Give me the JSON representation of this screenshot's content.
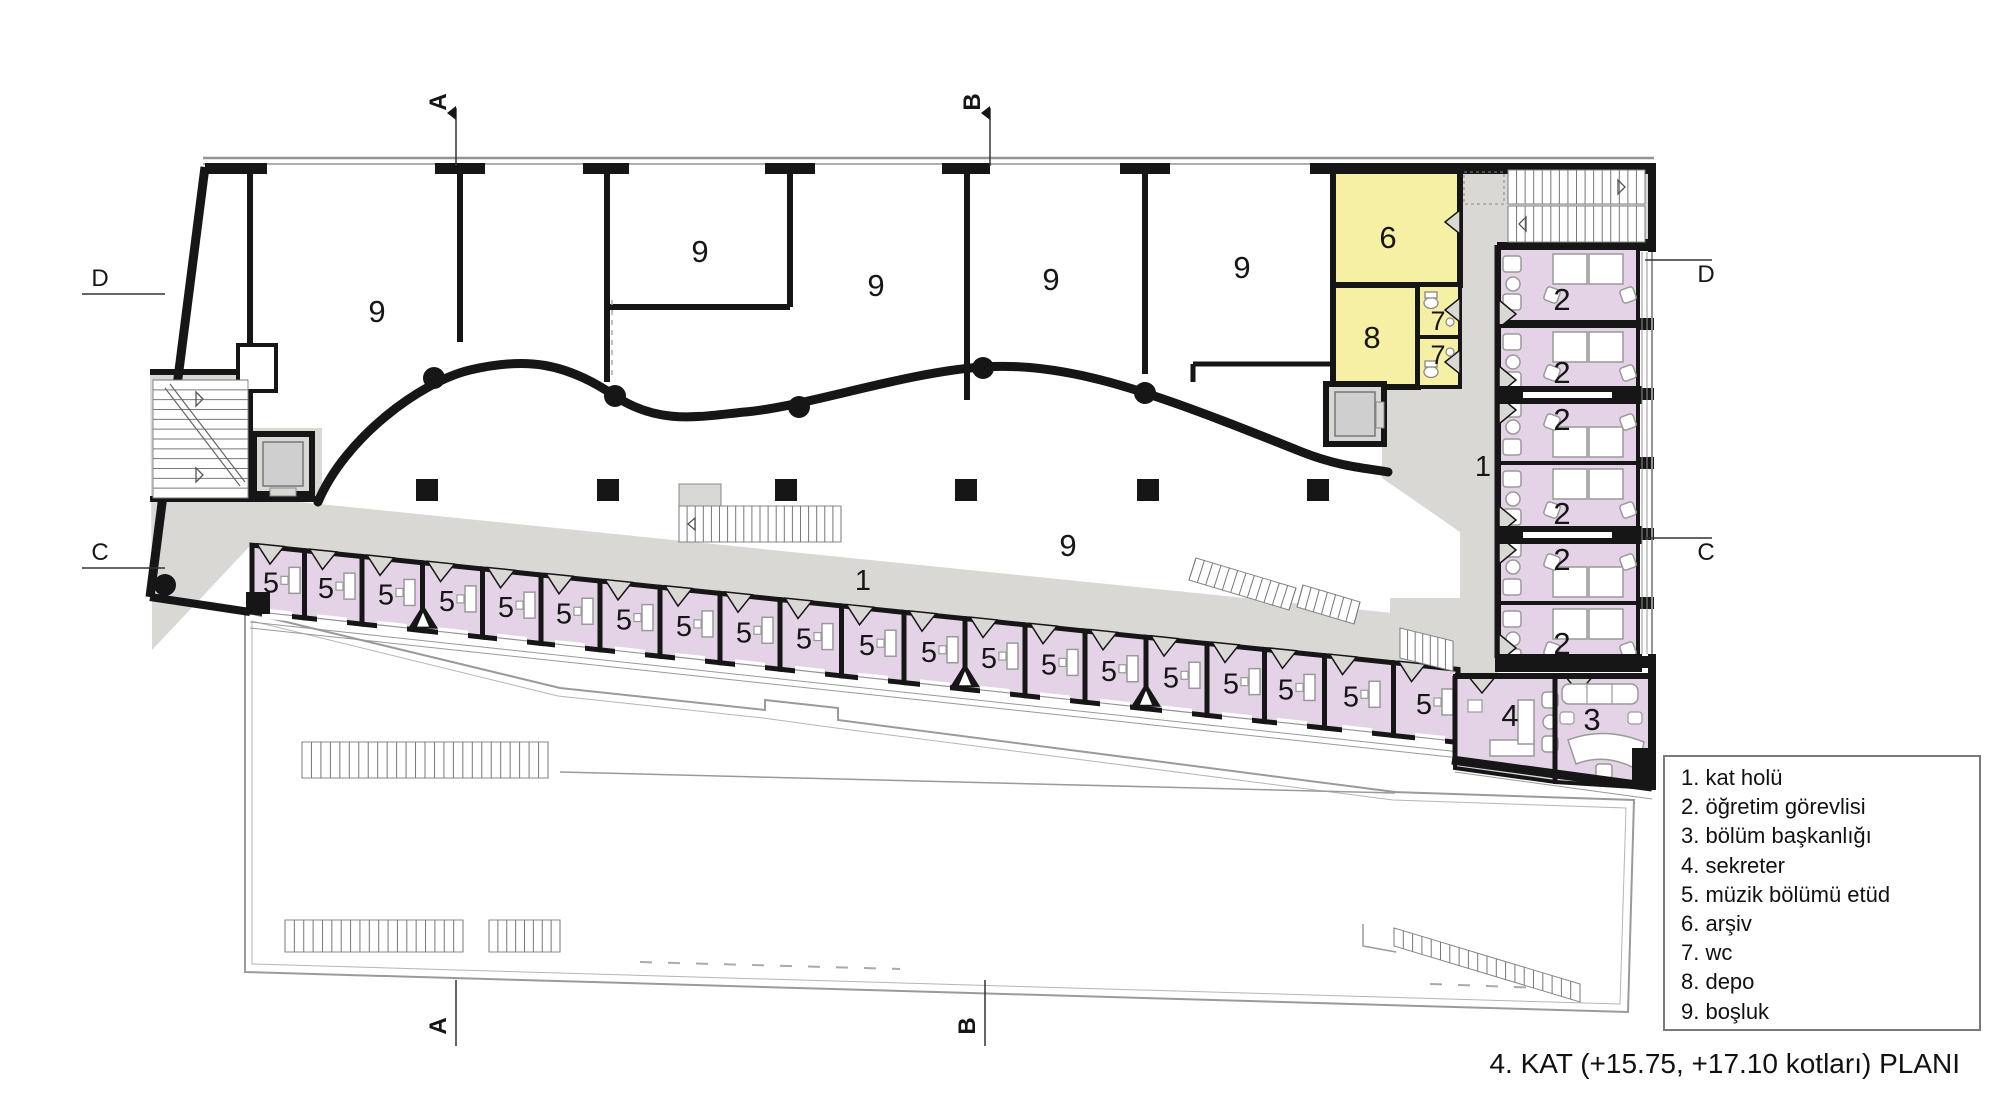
{
  "title": "4. KAT  (+15.75, +17.10 kotları) PLANI",
  "legend": [
    "1. kat holü",
    "2. öğretim görevlisi",
    "3. bölüm başkanlığı",
    "4. sekreter",
    "5. müzik bölümü etüd",
    "6. arşiv",
    "7. wc",
    "8. depo",
    "9. boşluk"
  ],
  "numbers": {
    "hall": "1",
    "office": "2",
    "head": "3",
    "secretary": "4",
    "etud": "5",
    "archive": "6",
    "wc": "7",
    "depot": "8",
    "void": "9"
  },
  "markers": {
    "top": [
      {
        "label": "A",
        "x": 456
      },
      {
        "label": "B",
        "x": 990
      }
    ],
    "bottom": [
      {
        "label": "A",
        "x": 456
      },
      {
        "label": "B",
        "x": 985
      }
    ],
    "left": [
      {
        "label": "D",
        "y": 278
      },
      {
        "label": "C",
        "y": 552
      }
    ],
    "right": [
      {
        "label": "D",
        "y": 274
      },
      {
        "label": "C",
        "y": 552
      }
    ]
  },
  "labels": {
    "nine": [
      [
        377,
        322
      ],
      [
        700,
        262
      ],
      [
        876,
        296
      ],
      [
        1051,
        290
      ],
      [
        1242,
        278
      ],
      [
        1068,
        556
      ]
    ],
    "one": [
      [
        863,
        590
      ],
      [
        1483,
        476
      ]
    ],
    "five_x": [
      277,
      332,
      392,
      453,
      512,
      570,
      630,
      690,
      750,
      810,
      873,
      935,
      995,
      1055,
      1115,
      1177,
      1237,
      1292,
      1357,
      1430
    ],
    "two_y": [
      300,
      373,
      420,
      514,
      560,
      644
    ],
    "four": [
      1510,
      726
    ],
    "three": [
      1592,
      730
    ],
    "six": [
      1388,
      248
    ],
    "eight": [
      1372,
      348
    ],
    "seven": [
      [
        1438,
        330
      ],
      [
        1438,
        364
      ]
    ]
  },
  "colors": {
    "wall": "#161616",
    "room_purple": "#e4d3e6",
    "room_yellow": "#f5f0a4",
    "corridor": "#d9d8d5",
    "thin_line": "#949494",
    "paper": "#ffffff"
  }
}
